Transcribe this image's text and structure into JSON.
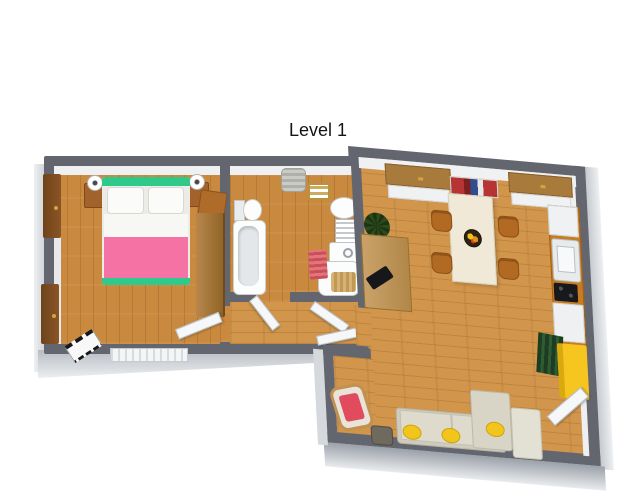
{
  "title": "Level 1",
  "floorplan": {
    "level_label": "Level 1",
    "style": "3d-top-down-rendering",
    "rooms": [
      {
        "name": "bedroom",
        "furniture": [
          "double-bed",
          "pillow-left",
          "pillow-right",
          "pink-blanket",
          "nightstand-left",
          "nightstand-right",
          "table-lamp-left",
          "table-lamp-right",
          "built-in-wardrobe-upper",
          "built-in-wardrobe-lower",
          "tall-wardrobe",
          "valet-stool",
          "keyboard-bench",
          "radiator",
          "door-to-hallway"
        ]
      },
      {
        "name": "bathroom",
        "furniture": [
          "laundry-basket",
          "towel-shelf",
          "toilet",
          "bathtub",
          "washbasin",
          "towel-radiator",
          "washing-machine",
          "shower-tray-with-duckboard",
          "striped-bath-mat",
          "door-to-hallway"
        ]
      },
      {
        "name": "hallway",
        "furniture": [
          "door-to-living-room"
        ]
      },
      {
        "name": "living-room-kitchen",
        "furniture": [
          "sideboard-left",
          "wall-shelf-with-books",
          "sideboard-right",
          "dining-table",
          "fruit-bowl",
          "dining-chair-1",
          "dining-chair-2",
          "dining-chair-3",
          "dining-chair-4",
          "office-desk",
          "monitor",
          "potted-plant",
          "kitchen-counter",
          "kitchen-upper-cabinet",
          "kitchen-sink",
          "cooktop",
          "dishwasher",
          "green-slat-shelf",
          "yellow-wardrobe",
          "corner-sofa",
          "chaise",
          "ottoman",
          "yellow-cushion-1",
          "yellow-cushion-2",
          "yellow-cushion-3",
          "rocking-chair",
          "side-table",
          "entrance-door"
        ]
      }
    ]
  },
  "colors": {
    "background": "#ffffff",
    "wall": "#63666e",
    "wall_face": "#e8eaed",
    "floor_wood": "#c9893f",
    "floor_wood_light": "#d1954b",
    "bed_frame": "#2fc98c",
    "bed_blanket": "#f473a4",
    "pillow": "#fbfbf9",
    "wardrobe_wood": "#7c4c1e",
    "nightstand": "#a2622a",
    "dining_table": "#f0e9d8",
    "chair": "#b26a22",
    "sofa": "#cfccbe",
    "cushion_yellow": "#f2c51d",
    "cabinet_yellow": "#f6c51f",
    "shelf_green": "#24482a",
    "bath_mat_red": "#cc4f58",
    "rocking_chair_cushion": "#e04b5e",
    "kitchen_counter": "#c87c22",
    "door": "#f6f7f8"
  }
}
